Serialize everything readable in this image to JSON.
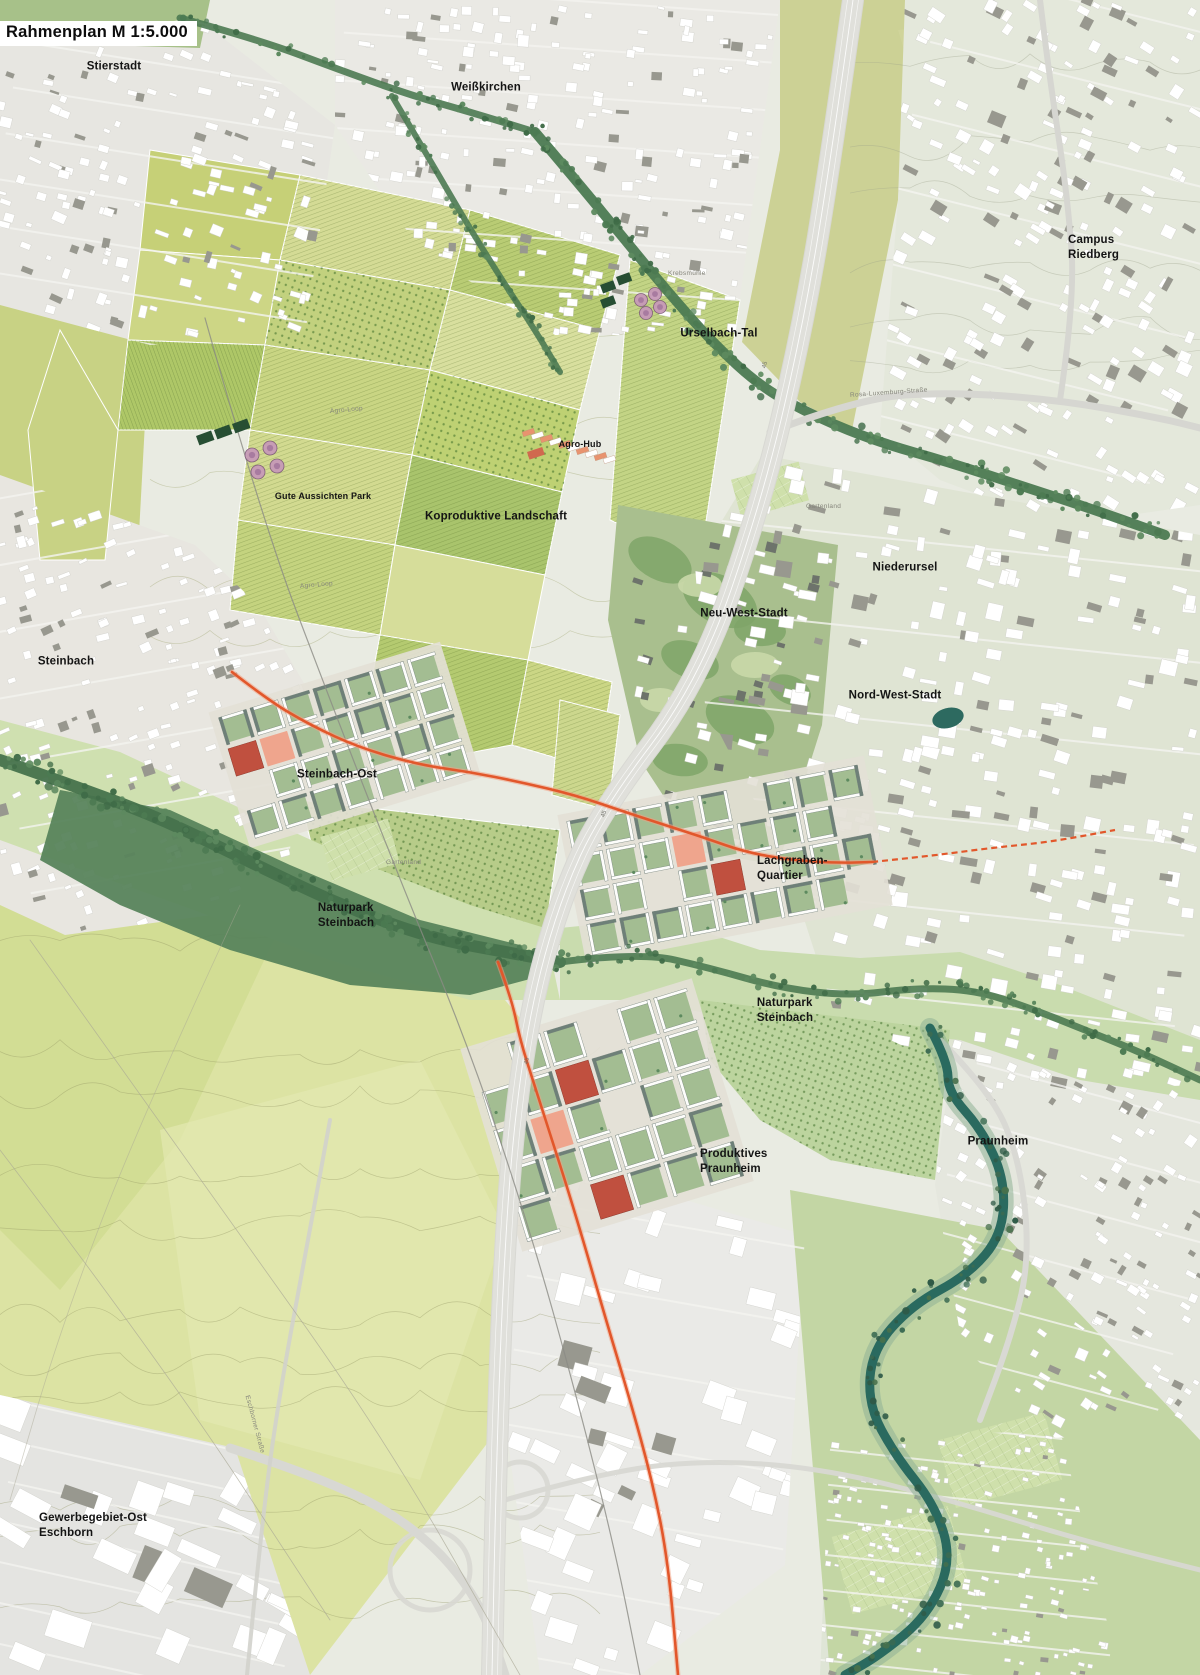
{
  "title": "Rahmenplan M 1:5.000",
  "labels": [
    {
      "id": "stierstadt",
      "lines": [
        "Stierstadt"
      ],
      "x": 114,
      "y": 67,
      "size": "lg",
      "align": "center"
    },
    {
      "id": "weisskirchen",
      "lines": [
        "Weißkirchen"
      ],
      "x": 486,
      "y": 88,
      "size": "lg",
      "align": "center"
    },
    {
      "id": "campus-riedberg",
      "lines": [
        "Campus Riedberg"
      ],
      "x": 1112,
      "y": 248,
      "size": "lg",
      "align": "center"
    },
    {
      "id": "urselbach-tal",
      "lines": [
        "Urselbach-Tal"
      ],
      "x": 719,
      "y": 334,
      "size": "lg",
      "align": "center"
    },
    {
      "id": "agro-hub",
      "lines": [
        "Agro-Hub"
      ],
      "x": 580,
      "y": 445,
      "size": "sm",
      "align": "center"
    },
    {
      "id": "gute-aussichten-park",
      "lines": [
        "Gute Aussichten Park"
      ],
      "x": 323,
      "y": 497,
      "size": "sm",
      "align": "center"
    },
    {
      "id": "koproduktive-landschaft",
      "lines": [
        "Koproduktive Landschaft"
      ],
      "x": 496,
      "y": 517,
      "size": "lg",
      "align": "center"
    },
    {
      "id": "niederursel",
      "lines": [
        "Niederursel"
      ],
      "x": 905,
      "y": 568,
      "size": "lg",
      "align": "center"
    },
    {
      "id": "neu-west-stadt",
      "lines": [
        "Neu-West-Stadt"
      ],
      "x": 744,
      "y": 614,
      "size": "lg",
      "align": "center"
    },
    {
      "id": "nord-west-stadt",
      "lines": [
        "Nord-West-Stadt"
      ],
      "x": 895,
      "y": 696,
      "size": "lg",
      "align": "center"
    },
    {
      "id": "steinbach",
      "lines": [
        "Steinbach"
      ],
      "x": 66,
      "y": 662,
      "size": "lg",
      "align": "center"
    },
    {
      "id": "steinbach-ost",
      "lines": [
        "Steinbach-Ost"
      ],
      "x": 337,
      "y": 775,
      "size": "lg",
      "align": "center"
    },
    {
      "id": "lachgraben-quartier",
      "lines": [
        "Lachgraben-",
        "Quartier"
      ],
      "x": 757,
      "y": 869,
      "size": "lg",
      "align": "left"
    },
    {
      "id": "naturpark-steinbach-west",
      "lines": [
        "Naturpark",
        "Steinbach"
      ],
      "x": 346,
      "y": 916,
      "size": "lg",
      "align": "center"
    },
    {
      "id": "naturpark-steinbach-ost",
      "lines": [
        "Naturpark",
        "Steinbach"
      ],
      "x": 785,
      "y": 1011,
      "size": "lg",
      "align": "center"
    },
    {
      "id": "produktives-praunheim",
      "lines": [
        "Produktives",
        "Praunheim"
      ],
      "x": 700,
      "y": 1162,
      "size": "lg",
      "align": "left"
    },
    {
      "id": "praunheim",
      "lines": [
        "Praunheim"
      ],
      "x": 998,
      "y": 1142,
      "size": "lg",
      "align": "center"
    },
    {
      "id": "gewerbegebiet-ost-eschborn",
      "lines": [
        "Gewerbegebiet-Ost",
        "Eschborn"
      ],
      "x": 39,
      "y": 1526,
      "size": "lg",
      "align": "left"
    }
  ],
  "minor_labels": [
    {
      "id": "rosa-luxemburg-strasse",
      "text": "Rosa-Luxemburg-Straße",
      "x": 850,
      "y": 392,
      "rotate": -4
    },
    {
      "id": "eschborner-strasse",
      "text": "Eschborner Straße",
      "x": 247,
      "y": 1392,
      "rotate": 75
    },
    {
      "id": "krebsmuehle",
      "text": "Krebsmühle",
      "x": 668,
      "y": 270,
      "rotate": 0
    },
    {
      "id": "agro-loop-1",
      "text": "Agro-Loop",
      "x": 330,
      "y": 408,
      "rotate": -5
    },
    {
      "id": "agro-loop-2",
      "text": "Agro-Loop",
      "x": 300,
      "y": 583,
      "rotate": -5
    },
    {
      "id": "gartenland-1",
      "text": "Gartenland",
      "x": 806,
      "y": 503,
      "rotate": 0
    },
    {
      "id": "gartenland-2",
      "text": "Gartenland",
      "x": 386,
      "y": 859,
      "rotate": 0
    }
  ],
  "road_shields": [
    {
      "text": "45",
      "x": 762,
      "y": 362,
      "rotate": -78
    },
    {
      "text": "45",
      "x": 601,
      "y": 811,
      "rotate": -72
    },
    {
      "text": "45",
      "x": 524,
      "y": 1058,
      "rotate": -82
    }
  ],
  "colors": {
    "label_text": "#141414",
    "title_bg": "#ffffff",
    "route_orange": "#e2572b",
    "route_orange_light": "#f2a184",
    "river_teal": "#2a6a5f",
    "stream_green": "#4c7a52",
    "field_green": "#c6d077",
    "meadow_green": "#dce3a3",
    "urban_white": "#ffffff",
    "highway_gray": "#d8d8d3",
    "new_quarter_red": "#c0503f",
    "plaza_salmon": "#efa58d",
    "park_green": "#a9bf8e",
    "pond_teal": "#2d6a60"
  }
}
